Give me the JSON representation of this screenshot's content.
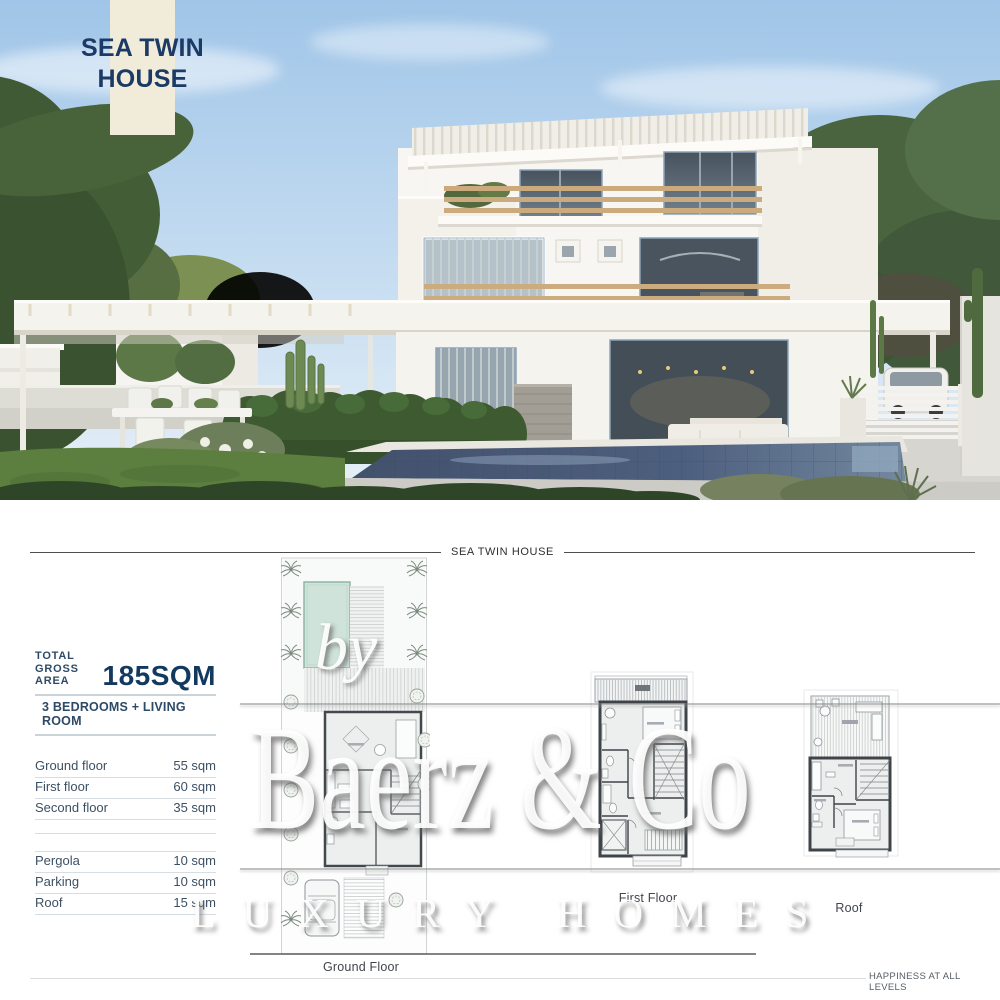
{
  "photo": {
    "badge": {
      "line1": "SEA TWIN",
      "line2": "HOUSE"
    },
    "description": "Render of a modern white twin villa with rooftop pergola, wood-beam balconies, swimming pool, lawn, hedge, outdoor dining set and a white car behind a slatted gate",
    "colors": {
      "sky": "#a3c7e8",
      "pool": "#4d5f7e",
      "lawn": "#5c7e3e",
      "badge_bg": "#f0ecd9",
      "badge_text": "#1c3a66"
    }
  },
  "plans_section": {
    "header_title": "SEA TWIN HOUSE",
    "specs": {
      "total_label_line1": "TOTAL",
      "total_label_line2": "GROSS AREA",
      "total_value": "185SQM",
      "subtitle": "3 BEDROOMS + LIVING ROOM",
      "rows": [
        {
          "label": "Ground floor",
          "value": "55 sqm"
        },
        {
          "label": "First floor",
          "value": "60 sqm"
        },
        {
          "label": "Second floor",
          "value": "35 sqm"
        },
        {
          "label": "Pergola",
          "value": "10 sqm"
        },
        {
          "label": "Parking",
          "value": "10 sqm"
        },
        {
          "label": "Roof",
          "value": "15 sqm"
        }
      ]
    },
    "plan_labels": {
      "ground": "Ground Floor",
      "first": "First Floor",
      "roof": "Roof"
    },
    "watermark": {
      "by": "by",
      "brand": "Baerz & Co",
      "tagline": "LUXURY HOMES"
    },
    "footer_tagline": "HAPPINESS AT ALL LEVELS",
    "accent_navy": "#1c3a66"
  }
}
